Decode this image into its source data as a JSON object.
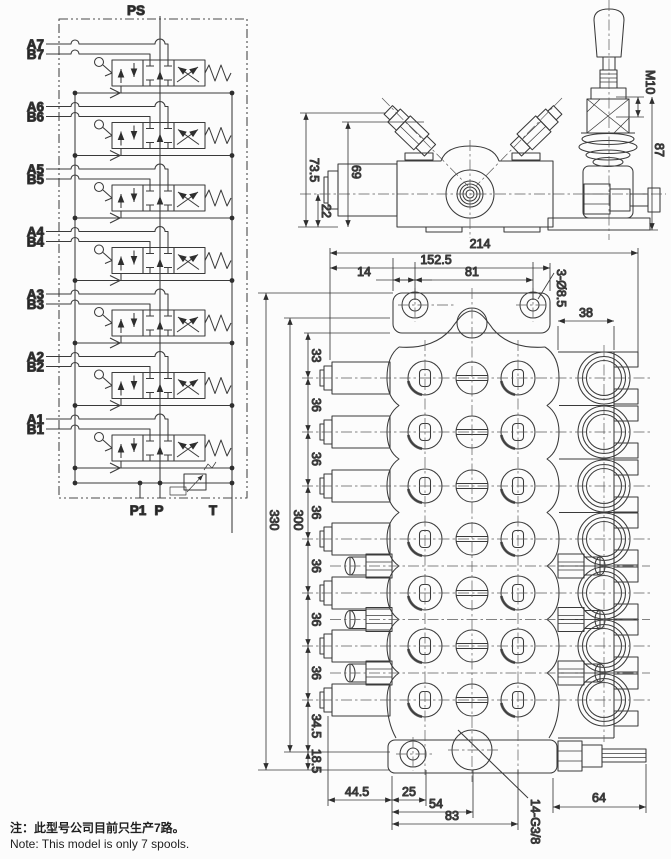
{
  "schematic": {
    "ps": "PS",
    "sections": [
      {
        "a": "A7",
        "b": "B7"
      },
      {
        "a": "A6",
        "b": "B6"
      },
      {
        "a": "A5",
        "b": "B5"
      },
      {
        "a": "A4",
        "b": "B4"
      },
      {
        "a": "A3",
        "b": "B3"
      },
      {
        "a": "A2",
        "b": "B2"
      },
      {
        "a": "A1",
        "b": "B1"
      }
    ],
    "p1": "P1",
    "p": "P",
    "t": "T"
  },
  "side_view": {
    "overall_height": "73.5",
    "body_height": "69",
    "port_height": "22",
    "lever_thread": "M10",
    "handle_height": "87"
  },
  "front_view": {
    "total_width": "214",
    "mount_width": "152.5",
    "hole_offset": "14",
    "hole_spacing": "81",
    "mount_holes": "3-Ø8.5",
    "end_width": "38",
    "sec_first": "33",
    "sec_pitch": "36",
    "sec_last": "34.5",
    "bottom_margin": "18.5",
    "overall_height": "330",
    "inner_height": "300",
    "bottom_1": "44.5",
    "bottom_2": "25",
    "bottom_3": "54",
    "bottom_4": "83",
    "bottom_5": "64",
    "port_thread": "14-G3/8"
  },
  "notes": {
    "zh": "注：此型号公司目前只生产7路。",
    "en": "Note: This model is only 7 spools."
  }
}
